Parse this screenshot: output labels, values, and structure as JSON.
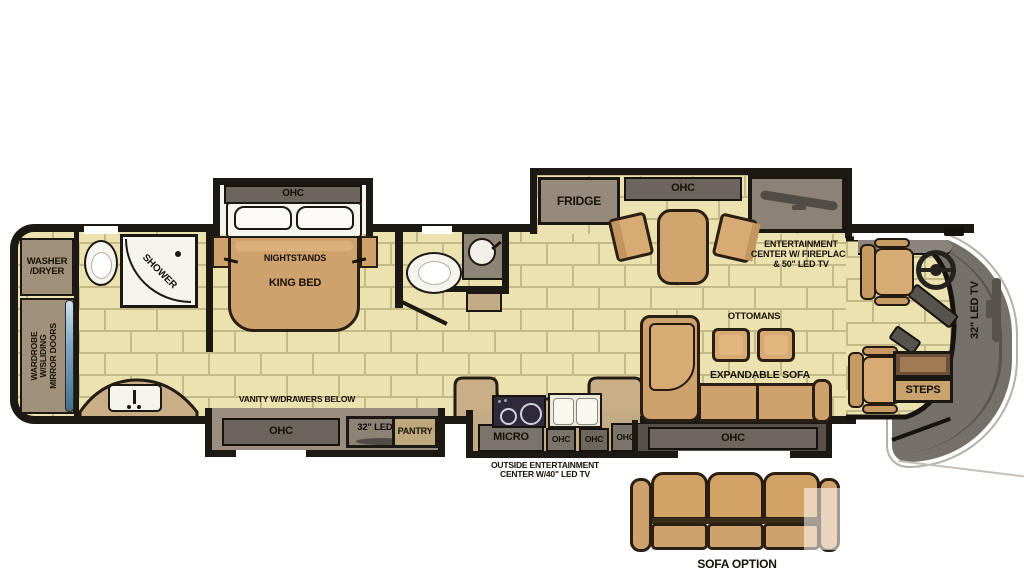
{
  "labels": {
    "ohc_bed": "OHC",
    "nightstands": "NIGHTSTANDS",
    "king_bed": "KING BED",
    "washer1": "WASHER",
    "washer2": "/DRYER",
    "wardrobe1": "WARDROBE",
    "wardrobe2": "W/SLIDING",
    "wardrobe3": "MIRROR DOORS",
    "shower": "SHOWER",
    "vanity": "VANITY W/DRAWERS BELOW",
    "ohc_vanity": "OHC",
    "tv_bedroom": "32\" LED TV",
    "pantry": "PANTRY",
    "fridge": "FRIDGE",
    "ohc_dinette": "OHC",
    "ent1": "ENTERTAINMENT",
    "ent2": "CENTER W/ FIREPLACE",
    "ent3": "& 50\" LED TV",
    "ottomans": "OTTOMANS",
    "exp_sofa": "EXPANDABLE SOFA",
    "ohc_sofa": "OHC",
    "micro": "MICRO",
    "ohc_k1": "OHC",
    "ohc_k2": "OHC",
    "ohc_k3": "OHC",
    "outside1": "OUTSIDE ENTERTAINMENT",
    "outside2": "CENTER W/40\" LED TV",
    "steps": "STEPS",
    "tv_front": "32\" LED TV",
    "sofa_option": "SOFA OPTION"
  },
  "colors": {
    "floor": "#ebe2b0",
    "grout": "#c6b989",
    "wall": "#1c1813",
    "cabinet_band": "#6b655e",
    "counter_tan": "#c9ae87",
    "furniture_tan": "#cfa26d",
    "cap_gray": "#75706a",
    "fixture_white": "#f6f4ee",
    "mirror_blue": "#7fa8c6"
  }
}
